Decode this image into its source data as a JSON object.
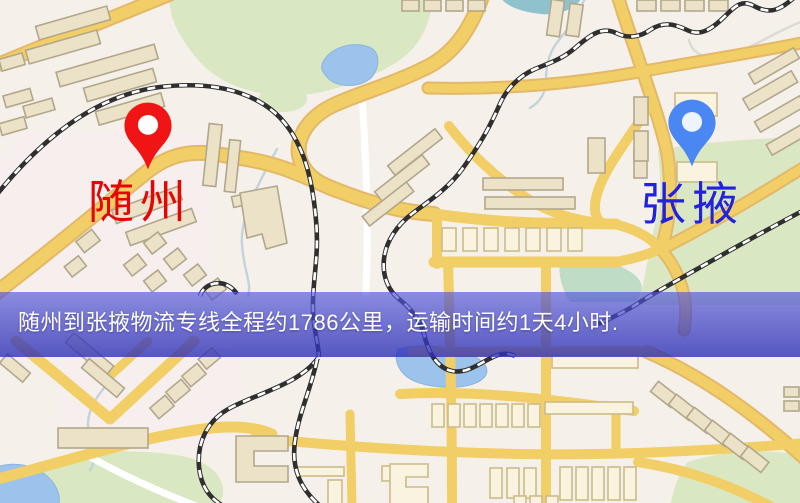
{
  "route_map": {
    "origin_label": "随州",
    "destination_label": "张掖",
    "banner_text": "随州到张掖物流专线全程约1786公里，运输时间约1天4小时."
  },
  "theme": {
    "origin_marker_color": "#f01414",
    "origin_label_color": "#e60404",
    "destination_marker_color": "#4b87f2",
    "destination_label_color": "#2222dd",
    "banner_bg_top": "rgba(84,88,218,0.66)",
    "banner_bg_bottom": "rgba(46,48,182,0.8)",
    "banner_text_color": "#ffffff",
    "map_background": "#f6f0ea",
    "road_fill": "#f2ce66",
    "road_edge": "#e3b868",
    "park_fill": "#d9e7c2",
    "park_teal": "#bedcc6",
    "water_fill": "#9cc3ec",
    "pond_teal": "#8fc2cc",
    "building_fill": "#ebe2c8",
    "building_stroke": "#b2a78b",
    "building_pale_fill": "#f9f3df",
    "building_pale_stroke": "#ccbc87",
    "railway_dark": "#2f2f2f",
    "stream": "#c2d3da",
    "white_road": "#ffffff"
  }
}
